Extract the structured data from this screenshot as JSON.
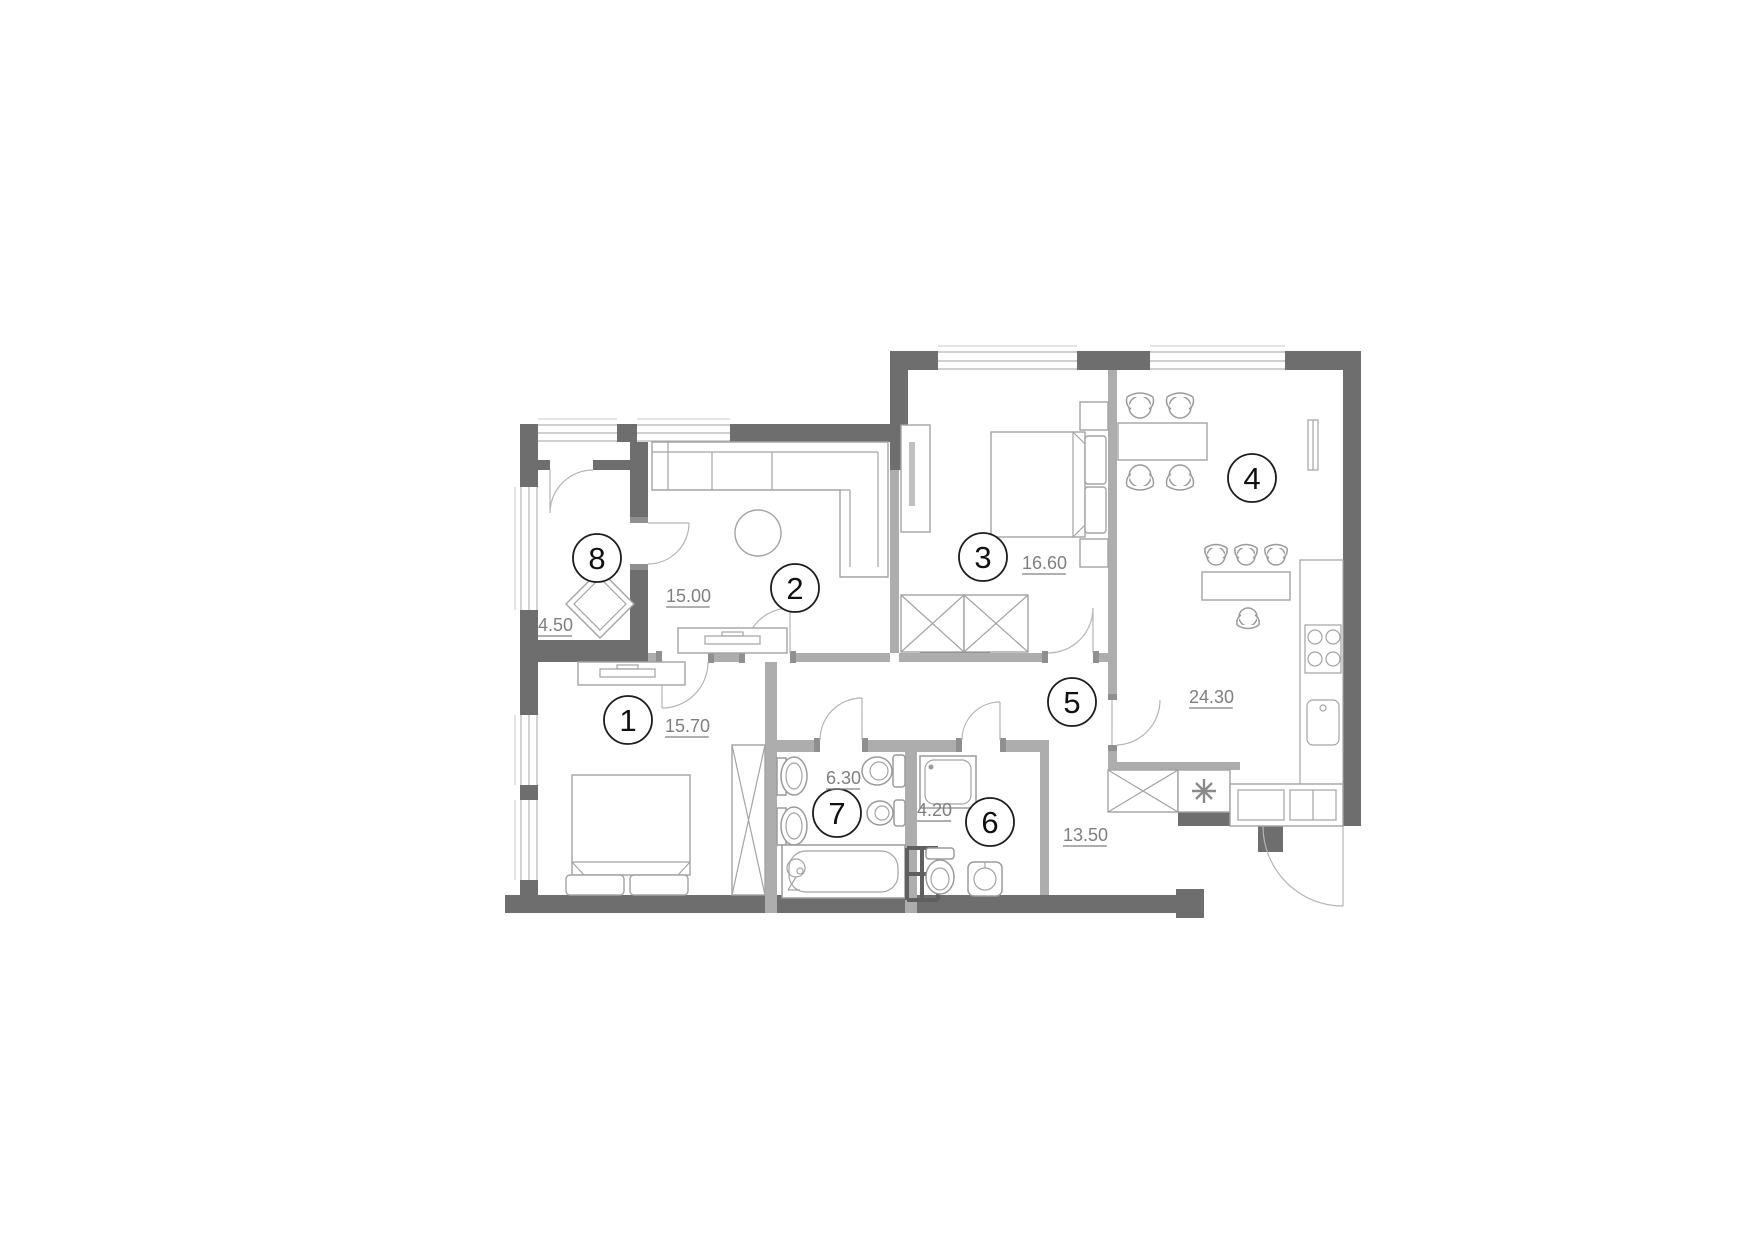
{
  "floor_plan": {
    "background": "#ffffff",
    "colors": {
      "exterior_wall": "#6e6e6e",
      "interior_wall": "#adadad",
      "furniture": "#a3a3a3",
      "fixture": "#9b9b9b",
      "door_arc": "#b5b5b5",
      "label_circle": "#1c1c1c",
      "area_text": "#7f7f7f"
    },
    "rooms": [
      {
        "number": "1",
        "area": "15.70",
        "circle": {
          "x": 628,
          "y": 720,
          "r": 24
        },
        "area_label": {
          "x": 665,
          "y": 732
        }
      },
      {
        "number": "2",
        "area": "15.00",
        "circle": {
          "x": 795,
          "y": 588,
          "r": 24
        },
        "area_label": {
          "x": 666,
          "y": 602
        }
      },
      {
        "number": "3",
        "area": "16.60",
        "circle": {
          "x": 983,
          "y": 557,
          "r": 24
        },
        "area_label": {
          "x": 1022,
          "y": 569
        }
      },
      {
        "number": "4",
        "area": "24.30",
        "circle": {
          "x": 1252,
          "y": 478,
          "r": 24
        },
        "area_label": {
          "x": 1189,
          "y": 703
        }
      },
      {
        "number": "5",
        "area": "13.50",
        "circle": {
          "x": 1072,
          "y": 702,
          "r": 24
        },
        "area_label": {
          "x": 1063,
          "y": 841
        }
      },
      {
        "number": "6",
        "area": "4.20",
        "circle": {
          "x": 990,
          "y": 822,
          "r": 24
        },
        "area_label": {
          "x": 917,
          "y": 816
        }
      },
      {
        "number": "7",
        "area": "6.30",
        "circle": {
          "x": 837,
          "y": 813,
          "r": 24
        },
        "area_label": {
          "x": 826,
          "y": 784
        }
      },
      {
        "number": "8",
        "area": "4.50",
        "circle": {
          "x": 597,
          "y": 558,
          "r": 24
        },
        "area_label": {
          "x": 538,
          "y": 631
        }
      }
    ]
  }
}
